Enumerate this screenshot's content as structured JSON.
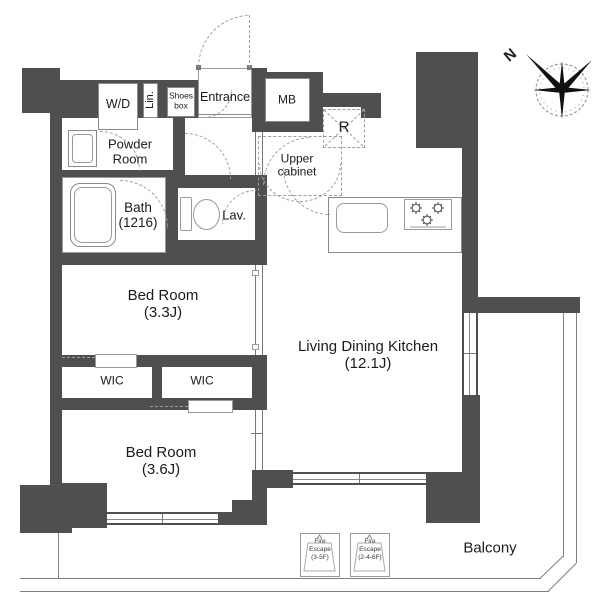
{
  "plan": {
    "labels": {
      "wd": "W/D",
      "lin": "Lin.",
      "shoes1": "Shoes",
      "shoes2": "box",
      "entrance": "Entrance",
      "mb": "MB",
      "powder1": "Powder",
      "powder2": "Room",
      "bath": "Bath",
      "bath_size": "(1216)",
      "lav": "Lav.",
      "upper1": "Upper",
      "upper2": "cabinet",
      "fridge": "R",
      "bed1": "Bed Room",
      "bed1_size": "(3.3J)",
      "wic_left": "WIC",
      "wic_right": "WIC",
      "bed2": "Bed Room",
      "bed2_size": "(3.6J)",
      "ldk": "Living Dining Kitchen",
      "ldk_size": "(12.1J)",
      "balcony": "Balcony",
      "compass_north": "N",
      "fire1_1": "Fire",
      "fire1_2": "Escape",
      "fire1_3": "(3-5F)",
      "fire2_1": "Fire",
      "fire2_2": "Escape",
      "fire2_3": "(2-4-6F)"
    },
    "colors": {
      "wall": "#4f4f4f",
      "thin_line": "#8a8a8a",
      "dash": "#9e9e9e",
      "text": "#1b1b1b",
      "bg": "#ffffff"
    }
  }
}
